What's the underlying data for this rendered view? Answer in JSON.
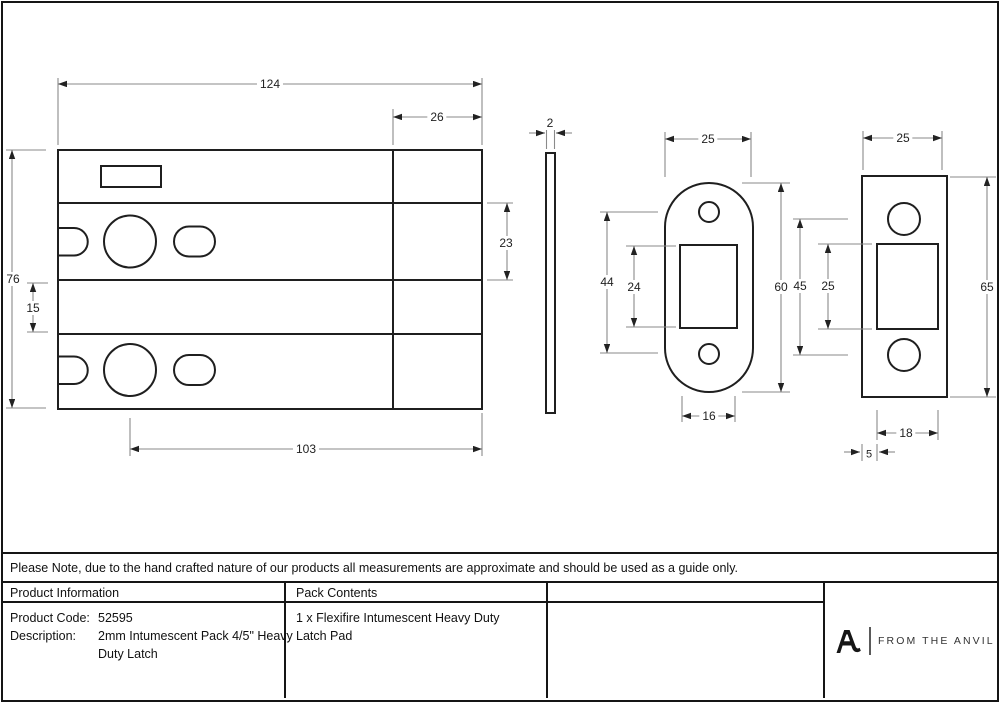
{
  "drawing": {
    "dimensions": {
      "plate_width": "124",
      "faceplate_depth": "26",
      "plate_height": "76",
      "lower_band_height": "15",
      "upper_band_height": "23",
      "backset_length": "103",
      "pack_thickness": "2",
      "radius_keep_width": "25",
      "radius_keep_hole_centres": "44",
      "radius_keep_aperture_height": "24",
      "radius_keep_height": "60",
      "radius_keep_aperture_width": "16",
      "square_keep_width": "25",
      "square_keep_hole_centres": "45",
      "square_keep_aperture_height": "25",
      "square_keep_height": "65",
      "square_keep_aperture_width": "18",
      "square_keep_aperture_inset": "5"
    }
  },
  "note": {
    "text": "Please Note, due to the hand crafted nature of our products all measurements are approximate and should be used as a guide only."
  },
  "table": {
    "product_info_header": "Product Information",
    "pack_contents_header": "Pack Contents",
    "product_code_label": "Product Code:",
    "product_code_value": "52595",
    "description_label": "Description:",
    "description_value": "2mm Intumescent Pack 4/5\" Heavy Duty Latch",
    "pack_contents_value": "1 x Flexifire Intumescent Heavy Duty Latch Pad"
  },
  "brand": {
    "mark": "anvil-a-icon",
    "logo_text": "FROM THE ANVIL"
  }
}
